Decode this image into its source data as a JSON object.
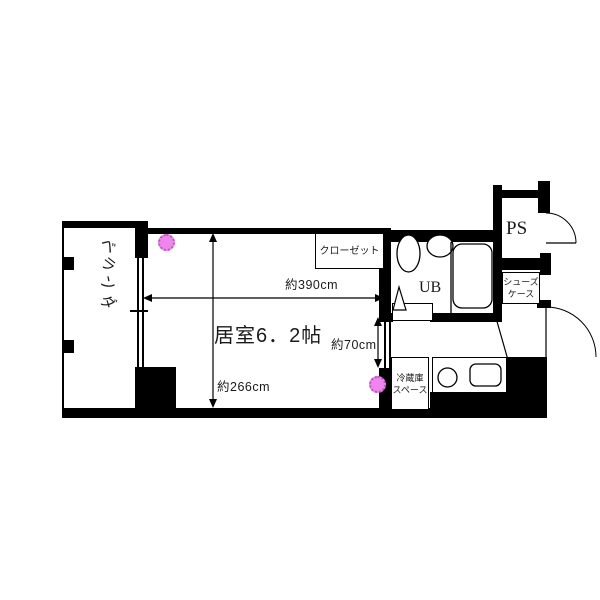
{
  "plan": {
    "living_room": {
      "label": "居室6．2帖"
    },
    "balcony": {
      "chars": [
        "ベ",
        "ラ",
        "ン",
        "ダ"
      ]
    },
    "closet": {
      "label": "クローゼット"
    },
    "unit_bath": {
      "label": "UB"
    },
    "pipe_space": {
      "label": "PS"
    },
    "shoe_case": {
      "line1": "シューズ",
      "line2": "ケース"
    },
    "fridge_space": {
      "line1": "冷蔵庫",
      "line2": "スペース"
    },
    "dimensions": {
      "width": "約390cm",
      "depth": "約266cm",
      "opening": "約70cm"
    },
    "colors": {
      "wall": "#000000",
      "background": "#ffffff",
      "marker_fill": "#ee86ee",
      "marker_border": "#bb55bb"
    }
  }
}
